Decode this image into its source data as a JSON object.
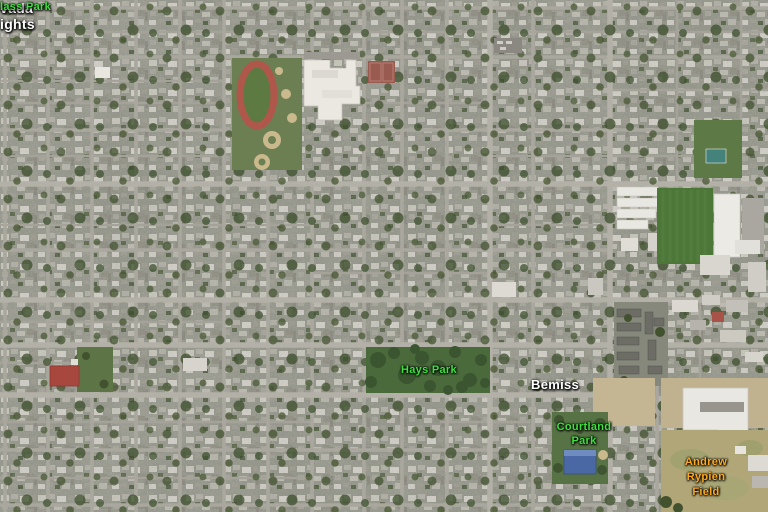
{
  "view": {
    "type": "aerial-satellite-imagery",
    "width_px": 768,
    "height_px": 512,
    "area_character": "dense suburban street grid with parks, schools and industrial lots"
  },
  "map_labels": {
    "nevada_heights": {
      "category": "neighborhood",
      "line1": "vada",
      "line2": "ights",
      "color": "#ffffff",
      "clipped": "left edge of view"
    },
    "lass_park": {
      "category": "park",
      "line1": "lass Park",
      "color": "#3ee13e",
      "clipped": "left edge of view"
    },
    "hays_park": {
      "category": "park",
      "line1": "Hays Park",
      "color": "#3ee13e"
    },
    "bemiss": {
      "category": "neighborhood",
      "line1": "Bemiss",
      "color": "#ffffff"
    },
    "courtland_park": {
      "category": "park",
      "line1": "Courtland",
      "line2": "Park",
      "color": "#3ee13e"
    },
    "andrew_rypien_field": {
      "category": "recreation-field",
      "line1": "Andrew",
      "line2": "Rypien",
      "line3": "Field",
      "color": "#ffa91f"
    }
  },
  "landmark_colors": {
    "street_grid": "#aaa89e",
    "running_track": "#b0574c",
    "school_building_roof": "#ebe8e2",
    "baseball_infield_sand": "#c9b98c",
    "tennis_courts": "#995a50",
    "park_tree_canopy": "#3a5530",
    "sports_field_grass": "#4d7639",
    "warehouse_roofs": "#e9e7e1",
    "apartment_roofs": "#6d6d66",
    "courtland_park_building": "#4a69a4",
    "red_roof_building": "#a8473e",
    "bare_dirt": "#c4b593",
    "rypien_field_ground": "#b0a678"
  }
}
